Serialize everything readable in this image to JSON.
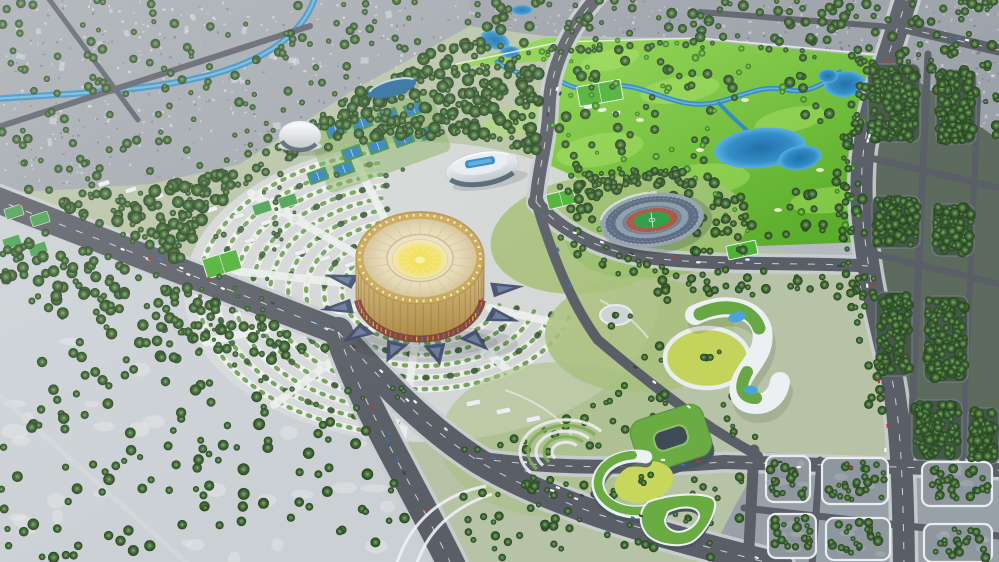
{
  "scene": {
    "type": "aerial architectural rendering",
    "setting": "master plan of a large sports-park district: golden circular arena with radiating arc gardens, athletics stadium, aquatics center, golf course with lakes, green-roof buildings and surrounding city blocks",
    "time_of_day": "day",
    "visible_text": ""
  },
  "landmarks": {
    "central_arena": "central golden circular arena with sunburst roof",
    "arc_gardens": "concentric arc gardens around arena",
    "stadium": "open-air athletics stadium with track and pitch",
    "aquatic_center": "white shell aquatics center with rooftop pool",
    "dome_arena": "white dome arena",
    "leaf_building": "blue leaf-shaped pavilion",
    "golf_course": "golf course with river and lakes",
    "green_roof_complex": "green-roof building complex",
    "courtyard_building": "curved white building with green roofs, pools and round lawn courtyard",
    "amphitheater": "terraced amphitheater garden",
    "city_northwest": "dense city blocks with canal",
    "city_northeast": "city band behind golf course",
    "tree_grid_east": "tree-filled city grid blocks",
    "open_ground_southwest": "pale open ground with scattered trees",
    "blocks_southeast": "gray development blocks with young trees"
  },
  "colors": {
    "road": "#5a5e66",
    "road_edge": "#c9cdd1",
    "road_dash": "#ffffff",
    "path_white": "#edf0ee",
    "hedge": "#6f9b52",
    "hedge_dark": "#3a5a36",
    "navy": "#3a4766",
    "navy_light": "#8b9cc0",
    "water": "#2e86c1",
    "water_light": "#6ab7de",
    "arena_gold": "#c8a757",
    "arena_roof": "#e9dfbf",
    "arena_sun": "#f1df5f",
    "roof_green": "#6bab44",
    "pitch_green": "#2f9e45",
    "track_red": "#a85847",
    "pool_blue": "#2d84c4",
    "lawn_yellow": "#c3d35c",
    "golf_green": "#7cc83e",
    "city_gray": "#a2a8ae",
    "pale_ground": "#cad0d4",
    "block_gray": "#99a1a8",
    "car_palette": [
      "#f3f5f7",
      "#f3f5f7",
      "#e2e6ea",
      "#3c434b",
      "#b33a35",
      "#3a6fb0"
    ]
  }
}
